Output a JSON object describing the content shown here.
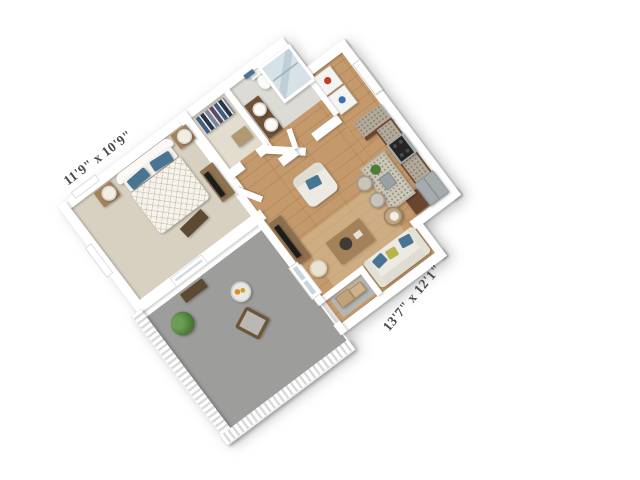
{
  "image": {
    "type": "3d-floorplan-rendering",
    "description": "Isometric 3D floor plan of a one-bedroom apartment, rotated about -37 degrees on a white background",
    "background_color": "#ffffff"
  },
  "dimension_labels": {
    "bedroom": "11'9\" x 10'9\"",
    "living_room": "13'7\" x 12'1\""
  },
  "rooms": {
    "bedroom": {
      "floor": "carpet",
      "furniture": [
        "bed",
        "headboard",
        "blue-pillows",
        "duvet",
        "nightstand-left",
        "nightstand-right",
        "lamp-left",
        "lamp-right",
        "foot-bench",
        "tv-dresser",
        "bedroom-tv",
        "window-left",
        "window-balcony"
      ]
    },
    "walk_in_closet": {
      "floor": "carpet",
      "furniture": [
        "clothes-rack",
        "closet-dresser"
      ]
    },
    "bathroom": {
      "floor": "tile",
      "furniture": [
        "vanity",
        "sink-left",
        "sink-right",
        "toilet",
        "shower",
        "blue-towel"
      ]
    },
    "laundry": {
      "floor": "hardwood",
      "furniture": [
        "washer",
        "dryer"
      ]
    },
    "entry": {
      "floor": "hardwood",
      "furniture": [
        "entry-door"
      ]
    },
    "kitchen": {
      "floor": "hardwood",
      "furniture": [
        "counter-return",
        "cabinet-run",
        "stove",
        "fridge",
        "island",
        "island-sink",
        "island-plant",
        "bar-stool-1",
        "bar-stool-2",
        "peninsula"
      ]
    },
    "living_room": {
      "floor": "hardwood",
      "furniture": [
        "tv-console",
        "living-tv",
        "pouf",
        "rug",
        "armchair",
        "coffee-table",
        "sofa",
        "sofa-pillows",
        "side-table",
        "table-lamp",
        "french-door"
      ]
    },
    "balcony": {
      "floor": "concrete",
      "furniture": [
        "balustrade",
        "potted-plant",
        "flower-table",
        "patio-chair",
        "patio-bench"
      ]
    },
    "storage": {
      "floor": "concrete",
      "furniture": [
        "box-1",
        "box-2"
      ]
    }
  },
  "palette": {
    "wall": "#ffffff",
    "carpet": "#d8d1c2",
    "closet_floor": "#e3ddd0",
    "hardwood": "#c49a6c",
    "tile": "#dcdbd5",
    "balcony_floor": "#9d9d9b",
    "storage_floor": "#b5b5b2",
    "cabinet_brown": "#6a4630",
    "granite": "#b3aa9b",
    "island_top": "#cdc7b8",
    "wood": "#a5815a",
    "wood_dark": "#5d4a33",
    "upholstery": "#eceae2",
    "accent_blue": "#4a7494",
    "accent_chartreuse": "#b9b34e",
    "accent_green": "#4d7c3a",
    "accent_orange": "#dd8a2c",
    "stainless": "#a6abae",
    "tv_black": "#1c1c1c",
    "glass": "#c9d6dd",
    "label_text": "#4b4b4b"
  }
}
